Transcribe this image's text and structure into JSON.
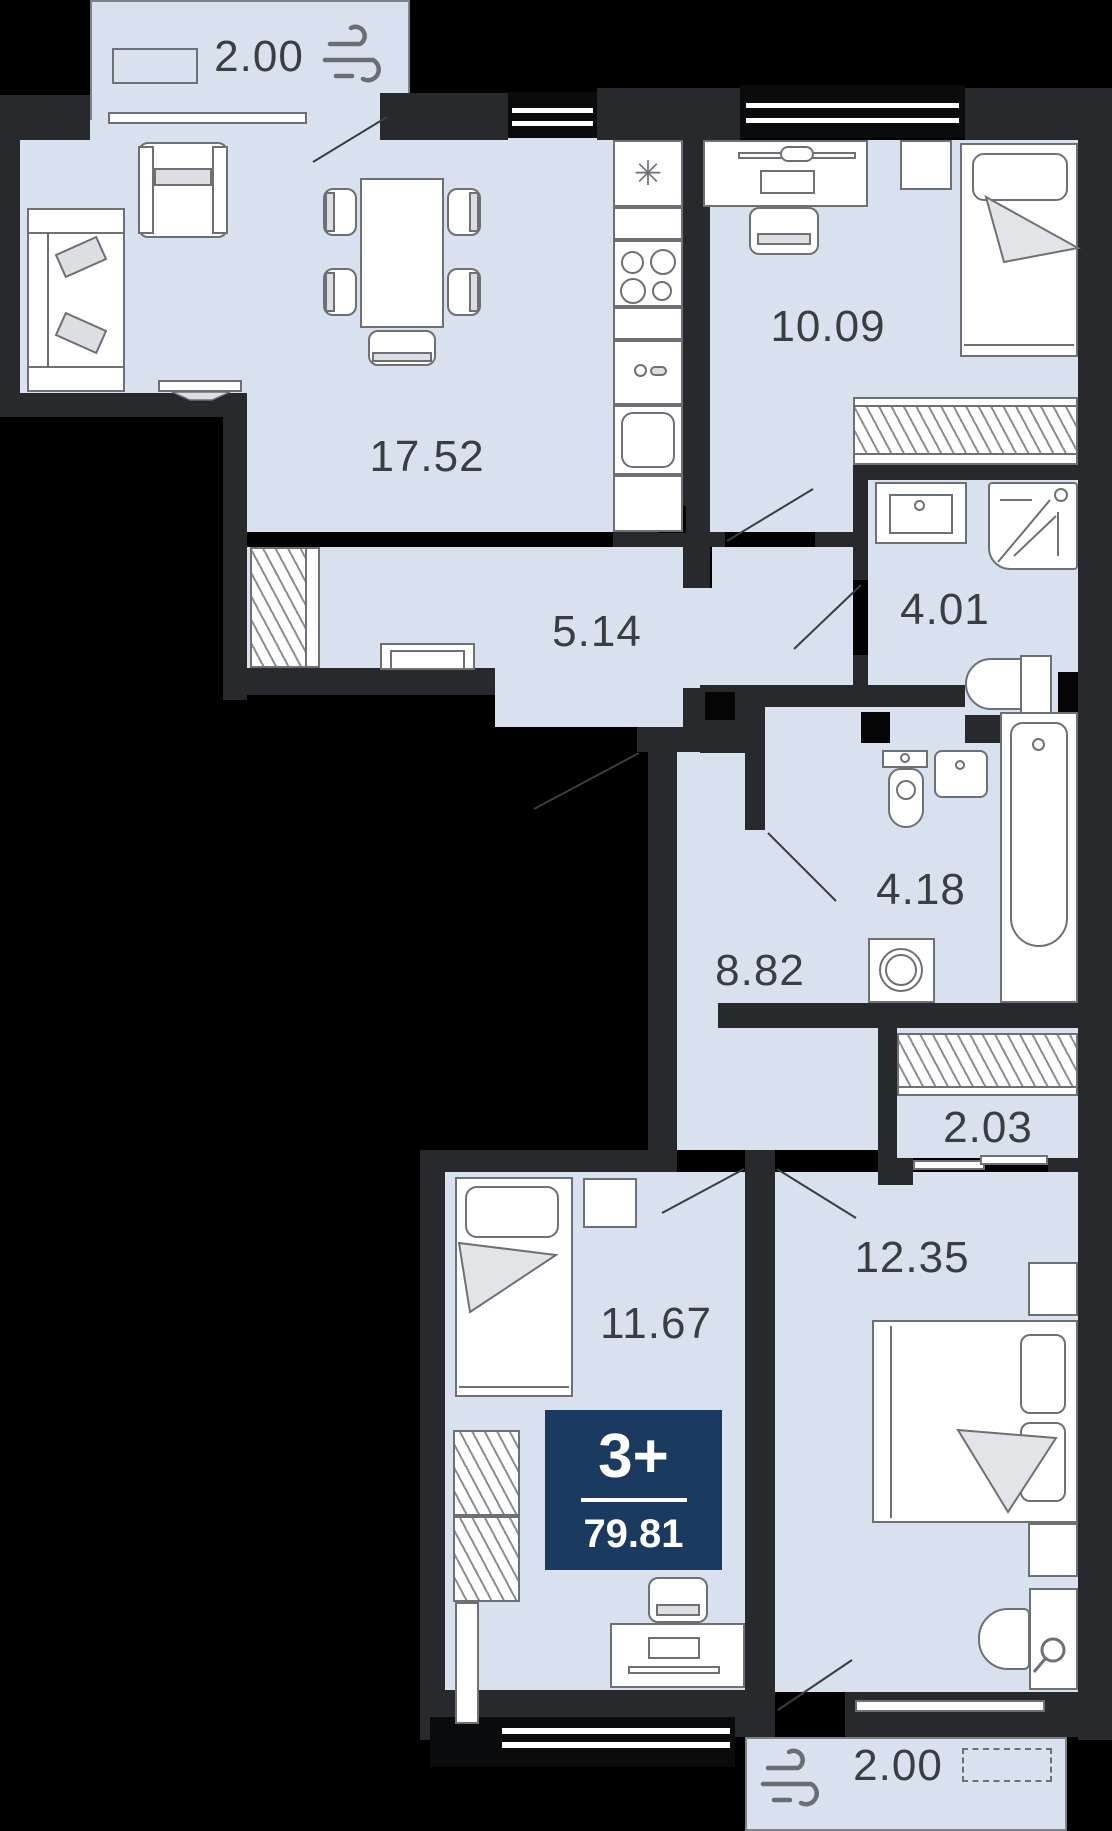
{
  "plan": {
    "type": "apartment floor plan",
    "badge": {
      "rooms_label": "3+",
      "total_area": "79.81"
    },
    "rooms": [
      {
        "id": "balcony-top",
        "area": "2.00"
      },
      {
        "id": "living-kitchen",
        "area": "17.52"
      },
      {
        "id": "bedroom-top",
        "area": "10.09"
      },
      {
        "id": "hallway",
        "area": "5.14"
      },
      {
        "id": "shower-room",
        "area": "4.01"
      },
      {
        "id": "bathroom",
        "area": "4.18"
      },
      {
        "id": "corridor",
        "area": "8.82"
      },
      {
        "id": "closet",
        "area": "2.03"
      },
      {
        "id": "bedroom-left",
        "area": "11.67"
      },
      {
        "id": "bedroom-right",
        "area": "12.35"
      },
      {
        "id": "balcony-bottom",
        "area": "2.00"
      }
    ],
    "icons": {
      "ventilation": "wind-icon",
      "fridge_glyph": "✳"
    },
    "colors": {
      "room_fill": "#d8e1ed",
      "wall": "#27292d",
      "background": "#000000",
      "badge_bg": "#1b3a5f",
      "label_text": "#3a3d41",
      "furniture_line": "#6d7176"
    }
  }
}
